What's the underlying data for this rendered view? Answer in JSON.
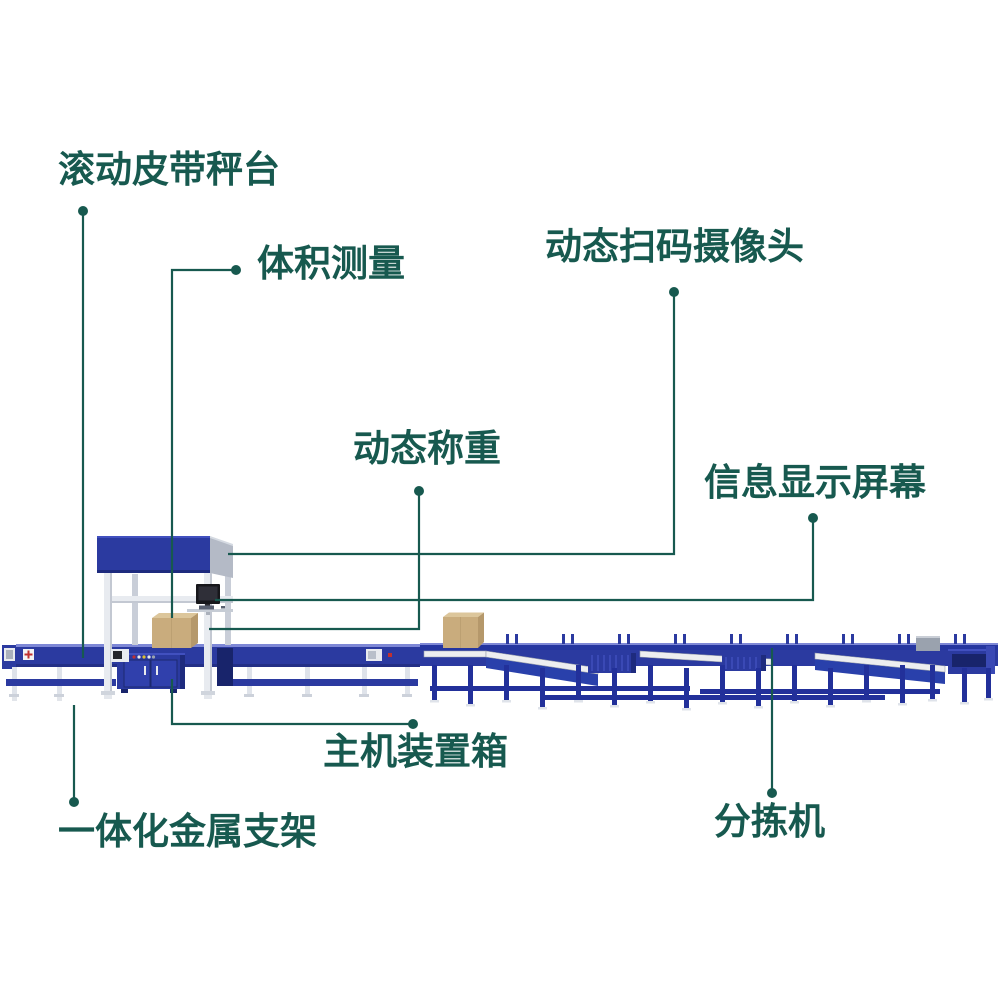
{
  "diagram": {
    "type": "product-callout-diagram",
    "subject": "parcel-sorting-conveyor-system",
    "background": "#ffffff"
  },
  "callouts": [
    {
      "id": "rolling-belt-scale",
      "label": "滚动皮带秤台"
    },
    {
      "id": "volume-measurement",
      "label": "体积测量"
    },
    {
      "id": "dynamic-scan-camera",
      "label": "动态扫码摄像头"
    },
    {
      "id": "dynamic-weighing",
      "label": "动态称重"
    },
    {
      "id": "info-display-screen",
      "label": "信息显示屏幕"
    },
    {
      "id": "main-unit-box",
      "label": "主机装置箱"
    },
    {
      "id": "integrated-metal-frame",
      "label": "一体化金属支架"
    },
    {
      "id": "sorter",
      "label": "分拣机"
    }
  ],
  "colors": {
    "callout_teal": "#17594F",
    "machine_blue": "#2B3AA0",
    "machine_blue_dark": "#1E2B7E",
    "machine_blue_bright": "#4150BF",
    "frame_steel": "#E8EBF0",
    "side_panel_grey": "#B4BAC6",
    "roller_white": "#EDEEF0",
    "carton_tan": "#C9AC7D",
    "monitor_black": "#17171B",
    "alert_red": "#C03030"
  }
}
